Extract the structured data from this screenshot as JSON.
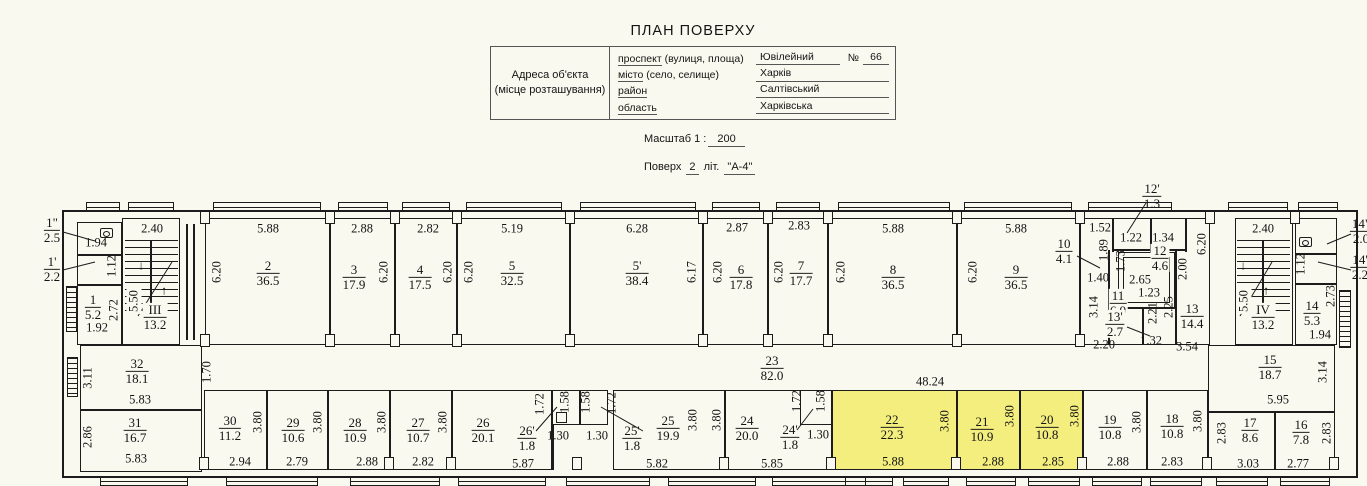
{
  "header": {
    "title": "ПЛАН ПОВЕРХУ",
    "address_caption_line1": "Адреса об'єкта",
    "address_caption_line2": "(місце розташування)",
    "rows": [
      {
        "key": "проспект",
        "rest": "  (вулиця, площа)",
        "value": "Ювілейний",
        "num_label": "№",
        "num_value": "66"
      },
      {
        "key": "місто",
        "rest": " (село, селище)",
        "value": "Харків"
      },
      {
        "key": "район",
        "rest": "",
        "value": "Салтівський"
      },
      {
        "key": "область",
        "rest": "",
        "value": "Харківська"
      }
    ],
    "scale_label": "Масштаб  1 :",
    "scale_value": "200",
    "floor_label": "Поверх",
    "floor_value": "2",
    "lit_label": "літ.",
    "lit_value": "\"А-4\""
  },
  "plan": {
    "line_color": "#1c1c1c",
    "bg_color": "#faf9f0",
    "highlight": "#f3ee7d",
    "outline": [
      62,
      210,
      1296,
      268
    ],
    "rooms": [
      [
        77,
        222,
        45,
        33
      ],
      [
        77,
        255,
        45,
        30
      ],
      [
        77,
        285,
        45,
        60
      ],
      [
        122,
        218,
        58,
        127
      ],
      [
        205,
        218,
        125,
        127
      ],
      [
        330,
        218,
        65,
        127
      ],
      [
        395,
        218,
        62,
        127
      ],
      [
        457,
        218,
        113,
        127
      ],
      [
        570,
        218,
        133,
        127
      ],
      [
        703,
        218,
        65,
        127
      ],
      [
        768,
        218,
        60,
        127
      ],
      [
        828,
        218,
        129,
        127
      ],
      [
        957,
        218,
        123,
        127
      ],
      [
        1080,
        218,
        130,
        127
      ],
      [
        1118,
        252,
        57,
        56
      ],
      [
        1123,
        257,
        47,
        46
      ],
      [
        1235,
        218,
        58,
        127
      ],
      [
        1295,
        218,
        42,
        36
      ],
      [
        1295,
        254,
        42,
        30
      ],
      [
        1295,
        284,
        42,
        61
      ],
      [
        80,
        345,
        122,
        65
      ],
      [
        80,
        410,
        122,
        62
      ],
      [
        204,
        390,
        63,
        80
      ],
      [
        267,
        390,
        61,
        80
      ],
      [
        328,
        390,
        62,
        80
      ],
      [
        390,
        390,
        62,
        80
      ],
      [
        452,
        390,
        100,
        80
      ],
      [
        552,
        390,
        28,
        35
      ],
      [
        580,
        390,
        28,
        35
      ],
      [
        556,
        412,
        11,
        11
      ],
      [
        613,
        390,
        112,
        80
      ],
      [
        725,
        390,
        107,
        80
      ],
      [
        800,
        390,
        32,
        35
      ],
      [
        832,
        390,
        125,
        80,
        "hl"
      ],
      [
        957,
        390,
        63,
        80,
        "hl"
      ],
      [
        1020,
        390,
        63,
        80,
        "hl"
      ],
      [
        1083,
        390,
        64,
        80
      ],
      [
        1147,
        390,
        61,
        80
      ],
      [
        1208,
        345,
        127,
        67
      ],
      [
        1208,
        412,
        67,
        58
      ],
      [
        1275,
        412,
        60,
        58
      ]
    ],
    "walls": [
      [
        186,
        224,
        2,
        116
      ],
      [
        193,
        224,
        2,
        116
      ],
      [
        1112,
        218,
        1.5,
        34
      ],
      [
        1150,
        218,
        1.5,
        34
      ],
      [
        1185,
        218,
        1.5,
        34
      ],
      [
        1112,
        249,
        75,
        1.5
      ],
      [
        1108,
        250,
        1.5,
        95
      ],
      [
        1108,
        307,
        67,
        1.5
      ],
      [
        1142,
        307,
        1.5,
        38
      ],
      [
        1175,
        250,
        1.5,
        95
      ],
      [
        552,
        425,
        1.5,
        45
      ],
      [
        150,
        240,
        1.5,
        72
      ],
      [
        1262,
        240,
        1.5,
        72
      ]
    ],
    "stair_treads": [
      [
        125,
        240,
        53,
        72
      ],
      [
        1237,
        240,
        53,
        72
      ]
    ],
    "hatches": [
      [
        66,
        286,
        11,
        46
      ],
      [
        67,
        357,
        11,
        40
      ],
      [
        1339,
        290,
        12,
        58
      ]
    ],
    "windows": [
      [
        86,
        202,
        34,
        10
      ],
      [
        128,
        202,
        46,
        10
      ],
      [
        213,
        202,
        108,
        10
      ],
      [
        338,
        202,
        50,
        10
      ],
      [
        402,
        202,
        48,
        10
      ],
      [
        466,
        202,
        96,
        10
      ],
      [
        580,
        202,
        116,
        10
      ],
      [
        712,
        202,
        48,
        10
      ],
      [
        776,
        202,
        44,
        10
      ],
      [
        838,
        202,
        112,
        10
      ],
      [
        964,
        202,
        108,
        10
      ],
      [
        1088,
        202,
        84,
        10
      ],
      [
        1228,
        202,
        60,
        10
      ],
      [
        1298,
        202,
        40,
        10
      ],
      [
        100,
        477,
        88,
        9
      ],
      [
        226,
        477,
        92,
        9
      ],
      [
        350,
        477,
        90,
        9
      ],
      [
        458,
        477,
        88,
        9
      ],
      [
        566,
        477,
        84,
        9
      ],
      [
        668,
        477,
        88,
        9
      ],
      [
        772,
        477,
        94,
        9
      ],
      [
        845,
        477,
        48,
        9
      ],
      [
        903,
        477,
        46,
        9
      ],
      [
        966,
        477,
        50,
        9
      ],
      [
        1028,
        477,
        52,
        9
      ],
      [
        1092,
        477,
        50,
        9
      ],
      [
        1150,
        477,
        52,
        9
      ],
      [
        1216,
        477,
        52,
        9
      ],
      [
        1280,
        477,
        50,
        9
      ]
    ],
    "pilasters": [
      [
        200,
        211
      ],
      [
        325,
        211
      ],
      [
        390,
        211
      ],
      [
        452,
        211
      ],
      [
        565,
        211
      ],
      [
        698,
        211
      ],
      [
        763,
        211
      ],
      [
        823,
        211
      ],
      [
        952,
        211
      ],
      [
        1075,
        211
      ],
      [
        1205,
        211
      ],
      [
        1290,
        211
      ],
      [
        200,
        334
      ],
      [
        325,
        334
      ],
      [
        390,
        334
      ],
      [
        452,
        334
      ],
      [
        565,
        334
      ],
      [
        698,
        334
      ],
      [
        763,
        334
      ],
      [
        823,
        334
      ],
      [
        952,
        334
      ],
      [
        1075,
        334
      ],
      [
        199,
        457
      ],
      [
        384,
        457
      ],
      [
        446,
        457
      ],
      [
        572,
        457
      ],
      [
        719,
        457
      ],
      [
        826,
        457
      ],
      [
        951,
        457
      ],
      [
        1077,
        457
      ],
      [
        1202,
        457
      ],
      [
        1329,
        457
      ]
    ],
    "leaders": [
      [
        63,
        232,
        95,
        241
      ],
      [
        63,
        270,
        95,
        262
      ],
      [
        1146,
        203,
        1127,
        233
      ],
      [
        1077,
        256,
        1100,
        268
      ],
      [
        536,
        431,
        557,
        407
      ],
      [
        643,
        431,
        601,
        407
      ],
      [
        797,
        430,
        813,
        409
      ],
      [
        1351,
        234,
        1327,
        244
      ],
      [
        1351,
        270,
        1318,
        262
      ],
      [
        1127,
        327,
        1150,
        336
      ],
      [
        172,
        262,
        138,
        316
      ],
      [
        1272,
        262,
        1240,
        316
      ]
    ],
    "toilets": [
      [
        100,
        228
      ],
      [
        1299,
        237
      ]
    ],
    "dims": [
      [
        "2.40",
        152,
        229
      ],
      [
        "5.88",
        268,
        229
      ],
      [
        "2.88",
        362,
        229
      ],
      [
        "2.82",
        428,
        229
      ],
      [
        "5.19",
        512,
        229
      ],
      [
        "6.28",
        637,
        229
      ],
      [
        "2.87",
        737,
        228
      ],
      [
        "2.83",
        799,
        226
      ],
      [
        "5.88",
        893,
        229
      ],
      [
        "5.88",
        1016,
        229
      ],
      [
        "1.52",
        1100,
        228
      ],
      [
        "1.22",
        1131,
        238
      ],
      [
        "1.34",
        1163,
        238
      ],
      [
        "2.40",
        1263,
        229
      ],
      [
        "1.94",
        96,
        243
      ],
      [
        "1.92",
        97,
        328
      ],
      [
        "2.65",
        1140,
        280,
        "b"
      ],
      [
        "1.40",
        1098,
        278
      ],
      [
        "1.23",
        1149,
        293
      ],
      [
        "2.20",
        1104,
        345
      ],
      [
        "1.32",
        1151,
        341
      ],
      [
        "3.54",
        1187,
        347
      ],
      [
        "1.94",
        1320,
        335
      ],
      [
        "5.95",
        1278,
        400
      ],
      [
        "5.83",
        140,
        400
      ],
      [
        "5.83",
        136,
        459
      ],
      [
        "2.94",
        240,
        462
      ],
      [
        "2.79",
        297,
        462
      ],
      [
        "2.88",
        367,
        462
      ],
      [
        "2.82",
        423,
        462
      ],
      [
        "5.87",
        523,
        464
      ],
      [
        "1.30",
        558,
        436
      ],
      [
        "1.30",
        597,
        436
      ],
      [
        "5.82",
        657,
        464
      ],
      [
        "5.85",
        772,
        464
      ],
      [
        "1.30",
        818,
        435
      ],
      [
        "5.88",
        893,
        462
      ],
      [
        "2.88",
        993,
        462
      ],
      [
        "2.85",
        1053,
        462
      ],
      [
        "2.88",
        1118,
        462
      ],
      [
        "2.83",
        1172,
        462
      ],
      [
        "3.03",
        1248,
        464
      ],
      [
        "2.77",
        1298,
        464
      ],
      [
        "48.24",
        930,
        382
      ],
      [
        "6.20",
        217,
        272,
        "v"
      ],
      [
        "6.20",
        384,
        272,
        "v"
      ],
      [
        "6.20",
        448,
        272,
        "v"
      ],
      [
        "6.20",
        469,
        272,
        "v"
      ],
      [
        "6.17",
        692,
        272,
        "v"
      ],
      [
        "6.20",
        718,
        272,
        "v"
      ],
      [
        "6.20",
        779,
        272,
        "v"
      ],
      [
        "6.20",
        841,
        272,
        "v"
      ],
      [
        "6.20",
        973,
        272,
        "v"
      ],
      [
        "6.20",
        1202,
        244,
        "v"
      ],
      [
        "5.50",
        134,
        301,
        "vb"
      ],
      [
        "5.50",
        1244,
        301,
        "vb"
      ],
      [
        "1.12",
        112,
        266,
        "v"
      ],
      [
        "2.72",
        114,
        310,
        "v"
      ],
      [
        "1.89",
        1104,
        250,
        "v"
      ],
      [
        "1.73",
        1121,
        261,
        "v"
      ],
      [
        "2.00",
        1183,
        269,
        "v"
      ],
      [
        "3.14",
        1094,
        307,
        "v"
      ],
      [
        "2.21",
        1153,
        313,
        "v"
      ],
      [
        "2.25",
        1169,
        307,
        "v"
      ],
      [
        "1.12",
        1301,
        264,
        "v"
      ],
      [
        "2.73",
        1331,
        296,
        "v"
      ],
      [
        "3.11",
        88,
        378,
        "v"
      ],
      [
        "2.86",
        88,
        437,
        "v"
      ],
      [
        "1.70",
        207,
        372,
        "v"
      ],
      [
        "3.14",
        1323,
        372,
        "v"
      ],
      [
        "3.80",
        258,
        422,
        "v"
      ],
      [
        "3.80",
        318,
        422,
        "v"
      ],
      [
        "3.80",
        382,
        422,
        "v"
      ],
      [
        "3.80",
        443,
        422,
        "v"
      ],
      [
        "3.80",
        693,
        420,
        "v"
      ],
      [
        "3.80",
        717,
        420,
        "v"
      ],
      [
        "3.80",
        945,
        421,
        "v"
      ],
      [
        "3.80",
        1010,
        416,
        "v"
      ],
      [
        "3.80",
        1075,
        416,
        "v"
      ],
      [
        "3.80",
        1137,
        422,
        "v"
      ],
      [
        "3.80",
        1198,
        421,
        "v"
      ],
      [
        "1.72",
        540,
        404,
        "v"
      ],
      [
        "1.58",
        565,
        402,
        "v"
      ],
      [
        "1.58",
        586,
        402,
        "v"
      ],
      [
        "1.72",
        612,
        403,
        "v"
      ],
      [
        "1.72",
        797,
        401,
        "v"
      ],
      [
        "1.58",
        821,
        401,
        "v"
      ],
      [
        "2.83",
        1222,
        433,
        "v"
      ],
      [
        "2.83",
        1327,
        433,
        "v"
      ],
      [
        "↓",
        141,
        266
      ],
      [
        "↑",
        164,
        291
      ],
      [
        "↓",
        1243,
        266
      ],
      [
        "↑",
        1266,
        291
      ]
    ],
    "fractions": [
      [
        "1\"",
        "2.5",
        52,
        230
      ],
      [
        "1'",
        "2.2",
        52,
        269
      ],
      [
        "1",
        "5.2",
        93,
        307
      ],
      [
        "III",
        "13.2",
        155,
        317,
        "b"
      ],
      [
        "2",
        "36.5",
        268,
        273
      ],
      [
        "3",
        "17.9",
        354,
        277
      ],
      [
        "4",
        "17.5",
        420,
        277
      ],
      [
        "5",
        "32.5",
        512,
        273
      ],
      [
        "5'",
        "38.4",
        637,
        273
      ],
      [
        "6",
        "17.8",
        741,
        277
      ],
      [
        "7",
        "17.7",
        801,
        273
      ],
      [
        "8",
        "36.5",
        893,
        277
      ],
      [
        "9",
        "36.5",
        1016,
        277
      ],
      [
        "10",
        "4.1",
        1064,
        251
      ],
      [
        "12'",
        "1.3",
        1152,
        196
      ],
      [
        "12",
        "4.6",
        1160,
        258,
        "b"
      ],
      [
        "11",
        "6.9",
        1118,
        303,
        "b"
      ],
      [
        "13'",
        "2.7",
        1115,
        324,
        "b"
      ],
      [
        "13",
        "14.4",
        1192,
        316
      ],
      [
        "IV",
        "13.2",
        1263,
        317,
        "b"
      ],
      [
        "14",
        "5.3",
        1312,
        313
      ],
      [
        "14\"",
        "2.0",
        1361,
        231
      ],
      [
        "14'",
        "2.2",
        1360,
        267
      ],
      [
        "15",
        "18.7",
        1270,
        367
      ],
      [
        "23",
        "82.0",
        772,
        368
      ],
      [
        "32",
        "18.1",
        137,
        371
      ],
      [
        "31",
        "16.7",
        135,
        430
      ],
      [
        "30",
        "11.2",
        230,
        428
      ],
      [
        "29",
        "10.6",
        293,
        430
      ],
      [
        "28",
        "10.9",
        355,
        430
      ],
      [
        "27",
        "10.7",
        418,
        430
      ],
      [
        "26",
        "20.1",
        483,
        430
      ],
      [
        "26'",
        "1.8",
        527,
        438
      ],
      [
        "25'",
        "1.8",
        632,
        438
      ],
      [
        "25",
        "19.9",
        668,
        428
      ],
      [
        "24",
        "20.0",
        747,
        428
      ],
      [
        "24'",
        "1.8",
        790,
        437
      ],
      [
        "22",
        "22.3",
        892,
        427
      ],
      [
        "21",
        "10.9",
        982,
        429
      ],
      [
        "20",
        "10.8",
        1047,
        427
      ],
      [
        "19",
        "10.8",
        1110,
        427
      ],
      [
        "18",
        "10.8",
        1172,
        426
      ],
      [
        "17",
        "8.6",
        1250,
        430
      ],
      [
        "16",
        "7.8",
        1301,
        432
      ]
    ]
  }
}
